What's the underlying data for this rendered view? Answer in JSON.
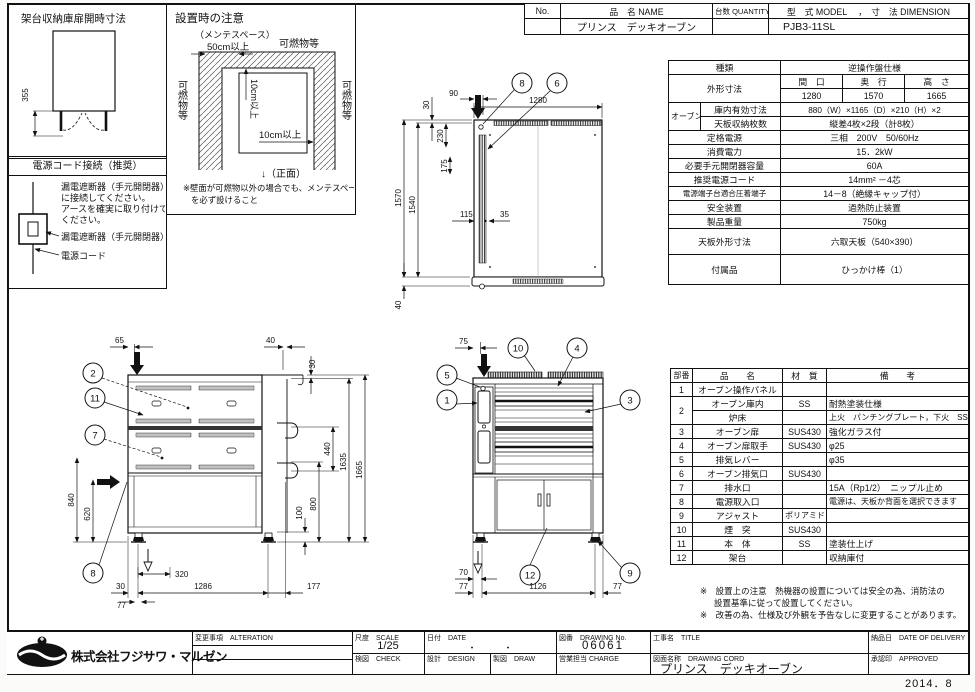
{
  "header_table": {
    "no_label": "No.",
    "name_label": "品　名 NAME",
    "qty_label": "台数 QUANTITY",
    "model_label": "型　式 MODEL　 ，　寸　法 DIMENSION",
    "product_name": "プリンス　デッキオーブン",
    "qty_value": "",
    "model_value": "PJB3-11SL"
  },
  "panels": {
    "cabinet": {
      "title": "架台収納庫扉開時寸法",
      "dim_open": "355"
    },
    "power": {
      "title": "電源コード接続（推奨）",
      "line1": "漏電遮断器（手元開閉器）",
      "line2": "に接続してください。",
      "line3": "アースを確実に取り付けて",
      "line4": "ください。",
      "label_breaker": "漏電遮断器（手元開閉器）",
      "label_cord": "電源コード"
    },
    "install": {
      "title": "設置時の注意",
      "maintenance": "（メンテスペース）",
      "clearance_front": "50cm以上",
      "flammable_top": "可燃物等",
      "flammable_left": "可燃物等",
      "flammable_right": "可燃物等",
      "clearance_side": "10cm以上",
      "clearance_back": "10cm以上",
      "front_label": "↓（正面）",
      "note_line1": "※壁面が可燃物以外の場合でも、メンテスペース",
      "note_line2": "を必ず設けること"
    }
  },
  "plan_view": {
    "balloons": {
      "b8": "8",
      "b6": "6"
    },
    "dims": {
      "width": "1280",
      "entry": "90",
      "top": "30",
      "total": "1570",
      "body": "1540",
      "vent_offset": "230",
      "vent_len": "175",
      "side": "115",
      "vent_w": "35",
      "front": "40"
    }
  },
  "rear_view": {
    "balloons": {
      "panel": "2",
      "body": "11",
      "drain": "7",
      "inlet": "8"
    },
    "dims": {
      "top_left": "65",
      "top_right": "40",
      "plate": "30",
      "lever_gap": "440",
      "body_h": "1635",
      "total_h": "1665",
      "lower_h": "800",
      "foot_adj": "100",
      "left_a": "840",
      "left_b": "620",
      "offset": "320",
      "edge": "30",
      "span": "1286",
      "right": "177",
      "foot": "77"
    }
  },
  "front_view": {
    "balloons": {
      "chimney": "10",
      "door_handle": "4",
      "vent_lever": "5",
      "panel": "1",
      "door": "3",
      "stand": "12",
      "adjuster": "9"
    },
    "dims": {
      "top": "75",
      "gap": "70",
      "foot_left": "77",
      "span": "1126",
      "foot_right": "77"
    }
  },
  "spec_table": {
    "kind_label": "種類",
    "kind_value": "逆操作盤仕様",
    "outer_label": "外形寸法",
    "w_label": "間　口",
    "d_label": "奥　行",
    "h_label": "高　さ",
    "w_value": "1280",
    "d_value": "1570",
    "h_value": "1665",
    "oven_label": "オーブン",
    "inner_label": "庫内有効寸法",
    "inner_value": "880（W）×1165（D）×210（H）×2",
    "tray_label": "天板収納枚数",
    "tray_value": "縦差4枚×2段（計8枚）",
    "power_label": "定格電源",
    "power_value": "三相　200V　50/60Hz",
    "consumption_label": "消費電力",
    "consumption_value": "15．2kW",
    "breaker_label": "必要手元開閉器容量",
    "breaker_value": "60A",
    "cord_label": "推奨電源コード",
    "cord_value": "14mm² －4芯",
    "terminal_label": "電源端子台適合圧着端子",
    "terminal_value": "14－8（絶縁キャップ付）",
    "safety_label": "安全装置",
    "safety_value": "過熱防止装置",
    "weight_label": "製品重量",
    "weight_value": "750kg",
    "tray_size_label": "天板外形寸法",
    "tray_size_value": "六取天板（540×390）",
    "accessory_label": "付属品",
    "accessory_value": "ひっかけ棒（1）"
  },
  "parts_table": {
    "header": {
      "no": "部番",
      "name": "品　　名",
      "material": "材　質",
      "remark": "備　　考"
    },
    "rows": [
      {
        "no": "1",
        "name": "オーブン操作パネル",
        "material": "",
        "remark": ""
      },
      {
        "no": "2",
        "name": "オーブン庫内",
        "material": "SS",
        "remark": "耐熱塗装仕様"
      },
      {
        "no": "",
        "name": "炉床",
        "material": "",
        "remark": "上火　パンチングプレート，下火　SS"
      },
      {
        "no": "3",
        "name": "オーブン扉",
        "material": "SUS430",
        "remark": "強化ガラス付"
      },
      {
        "no": "4",
        "name": "オーブン扉取手",
        "material": "SUS430",
        "remark": "φ25"
      },
      {
        "no": "5",
        "name": "排気レバー",
        "material": "",
        "remark": "φ35"
      },
      {
        "no": "6",
        "name": "オーブン排気口",
        "material": "SUS430",
        "remark": ""
      },
      {
        "no": "7",
        "name": "排水口",
        "material": "",
        "remark": "15A（Rp1/2）　ニップル止め"
      },
      {
        "no": "8",
        "name": "電源取入口",
        "material": "",
        "remark": "電源は、天板か背面を選択できます"
      },
      {
        "no": "9",
        "name": "アジャスト",
        "material": "ポリアミド",
        "remark": ""
      },
      {
        "no": "10",
        "name": "煙　突",
        "material": "SUS430",
        "remark": ""
      },
      {
        "no": "11",
        "name": "本　体",
        "material": "SS",
        "remark": "塗装仕上げ"
      },
      {
        "no": "12",
        "name": "架台",
        "material": "",
        "remark": "収納庫付"
      }
    ]
  },
  "notes": {
    "n1a": "※　設置上の注意　熱機器の設置については安全の為、消防法の",
    "n1b": "設置基準に従って設置してください。",
    "n2": "※　改善の為、仕様及び外観を予告なしに変更することがあります。"
  },
  "title_block": {
    "company": "株式会社フジサワ・マルゼン",
    "alteration_label": "変更事項　ALTERATION",
    "scale_label": "尺度　SCALE",
    "scale_value": "1/25",
    "date_label": "日付　DATE",
    "date_value": "・　　　・",
    "check_label": "検図　CHECK",
    "design_label": "設計　DESIGN",
    "draw_label": "製図　DRAW",
    "drawing_no_label": "図番　DRAWING No.",
    "drawing_no": "06061",
    "charge_label": "営業担当 CHARGE",
    "title_label": "工事名　TITLE",
    "drawing_name_label": "図面名称　DRAWING CORD",
    "drawing_name": "プリンス　デッキオーブン",
    "delivery_label": "納品日　DATE OF DELIVERY",
    "approved_label": "承認印　APPROVED"
  },
  "published": "2014．8"
}
